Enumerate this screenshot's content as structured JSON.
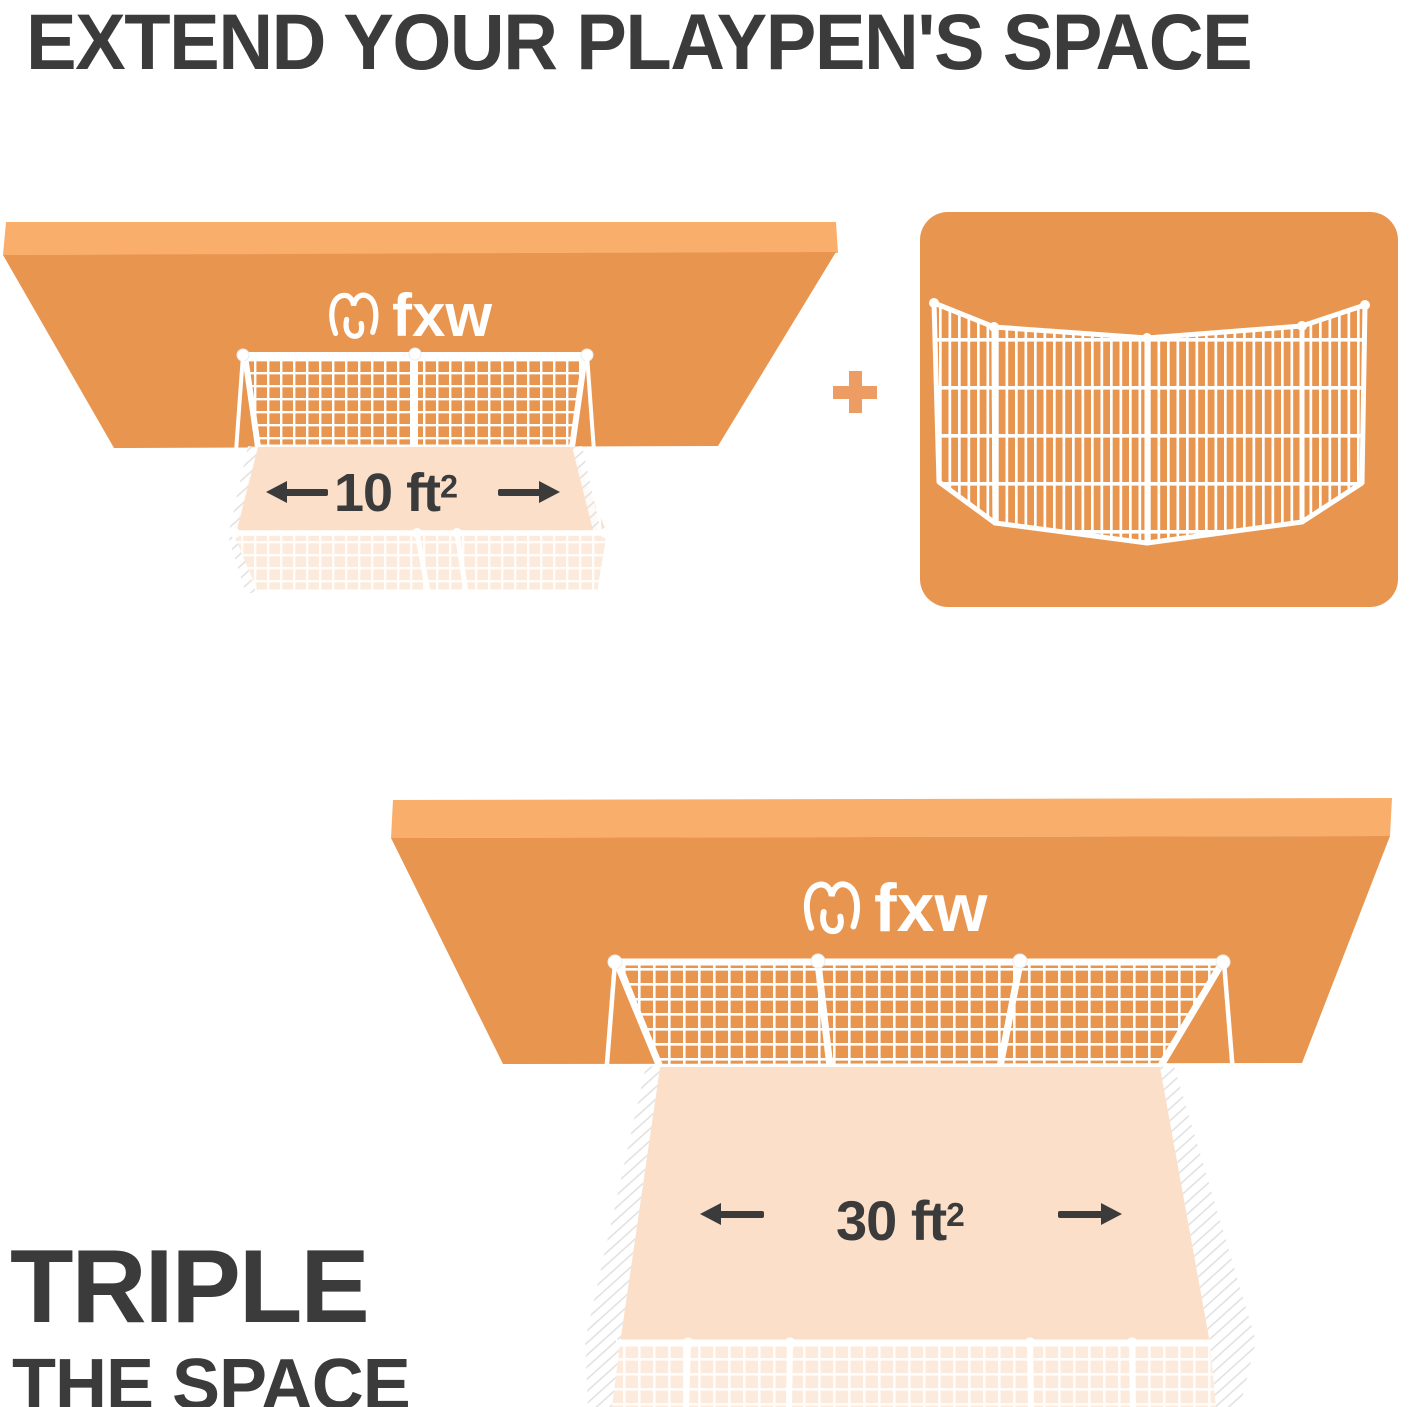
{
  "headline": "EXTEND YOUR PLAYPEN'S SPACE",
  "brand": {
    "name": "fxw",
    "logo_icon": "fxw-dog-logo-icon"
  },
  "scene_small": {
    "area_value": "10 ft",
    "area_sup": "2",
    "left_arrow_icon": "arrow-left-icon",
    "right_arrow_icon": "arrow-right-icon"
  },
  "plus_symbol": "+",
  "extension_card": {
    "content": "4-panel white wire fence extension",
    "icon": "fence-panels-icon"
  },
  "scene_large": {
    "area_value": "30 ft",
    "area_sup": "2",
    "left_arrow_icon": "arrow-left-icon",
    "right_arrow_icon": "arrow-right-icon"
  },
  "footer": {
    "line1": "TRIPLE",
    "line2": "THE SPACE"
  },
  "colors": {
    "background": "#ffffff",
    "text_dark": "#3b3b3b",
    "slab_face": "#e8954f",
    "slab_bevel": "#f9ae6b",
    "floor": "#fbdfc9",
    "floor_washed": "#fcebdd",
    "fence_white": "#ffffff",
    "plus_orange": "#ed9d64",
    "card_orange": "#e8954f"
  }
}
